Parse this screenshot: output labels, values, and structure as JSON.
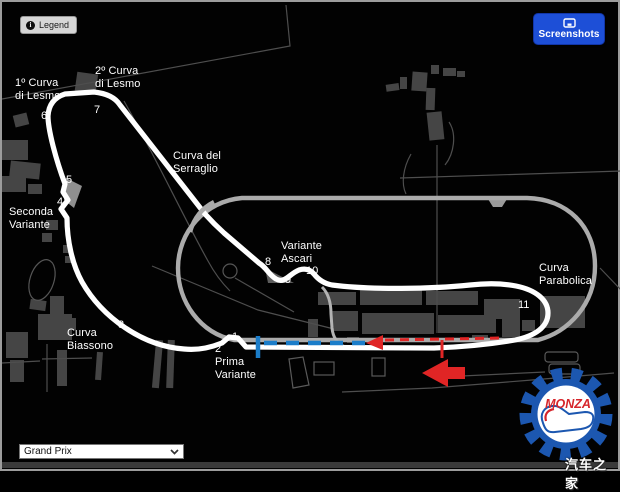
{
  "colors": {
    "button_blue": "#1d4fd7",
    "route_red": "#e02525",
    "route_blue": "#1b7dc9",
    "track_white": "#ffffff",
    "oval_gray": "#ababab",
    "logo_blue": "#1c57b0",
    "logo_red": "#d6252b"
  },
  "header": {
    "legend": {
      "label": "Legend"
    },
    "screenshots": {
      "label": "Screenshots"
    }
  },
  "map": {
    "circuit_name": "Monza",
    "corner_labels": [
      {
        "text": "1º Curva\ndi Lesmo",
        "x": 13,
        "y": 75
      },
      {
        "text": "2º Curva\ndi Lesmo",
        "x": 93,
        "y": 63
      },
      {
        "text": "Curva del\nSerraglio",
        "x": 171,
        "y": 148
      },
      {
        "text": "Seconda\nVariante",
        "x": 7,
        "y": 204
      },
      {
        "text": "Variante\nAscari",
        "x": 279,
        "y": 238
      },
      {
        "text": "Curva\nParabolica",
        "x": 537,
        "y": 260
      },
      {
        "text": "Curva\nBiassono",
        "x": 65,
        "y": 325
      },
      {
        "text": "Prima\nVariante",
        "x": 213,
        "y": 354
      }
    ],
    "turn_numbers": [
      {
        "n": "1",
        "x": 230,
        "y": 329
      },
      {
        "n": "2",
        "x": 213,
        "y": 341
      },
      {
        "n": "3",
        "x": 116,
        "y": 317
      },
      {
        "n": "4",
        "x": 55,
        "y": 194
      },
      {
        "n": "5",
        "x": 64,
        "y": 172
      },
      {
        "n": "6",
        "x": 39,
        "y": 108
      },
      {
        "n": "7",
        "x": 92,
        "y": 102
      },
      {
        "n": "8",
        "x": 263,
        "y": 254
      },
      {
        "n": "9",
        "x": 283,
        "y": 272
      },
      {
        "n": "10",
        "x": 304,
        "y": 263
      },
      {
        "n": "11",
        "x": 516,
        "y": 297
      }
    ]
  },
  "footer": {
    "layout_select": {
      "value": "Grand Prix"
    }
  },
  "logo": {
    "text": "MONZA"
  },
  "watermark": {
    "text": "汽车之家"
  }
}
